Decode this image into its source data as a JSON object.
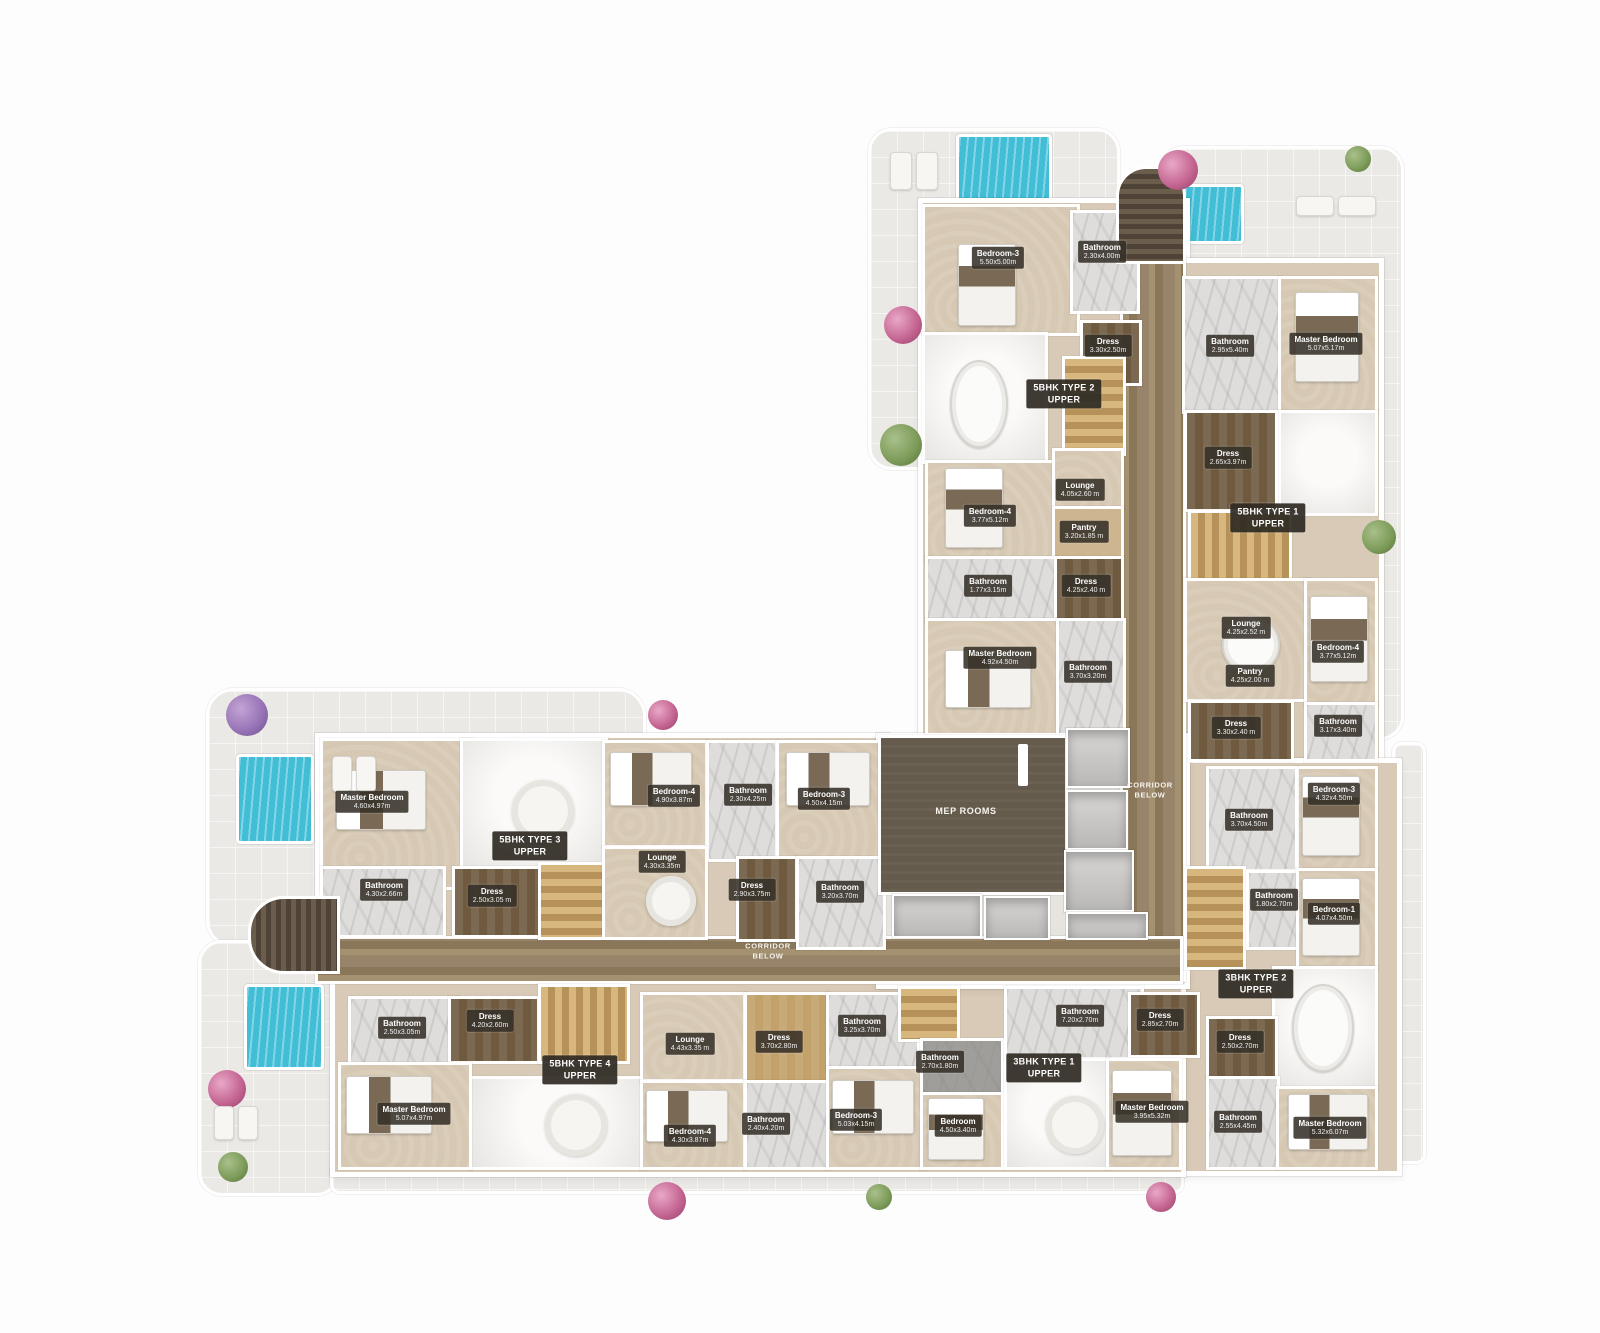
{
  "rooms": {
    "t2_bed3": {
      "name": "Bedroom-3",
      "dims": "5.50x5.00m"
    },
    "t2_bath1": {
      "name": "Bathroom",
      "dims": "2.30x4.00m"
    },
    "t2_dress1": {
      "name": "Dress",
      "dims": "3.30x2.50m"
    },
    "t2_lounge": {
      "name": "Lounge",
      "dims": "4.05x2.60 m"
    },
    "t2_pantry": {
      "name": "Pantry",
      "dims": "3.20x1.85 m"
    },
    "t2_bed4": {
      "name": "Bedroom-4",
      "dims": "3.77x5.12m"
    },
    "t2_bath2": {
      "name": "Bathroom",
      "dims": "1.77x3.15m"
    },
    "t2_dress2": {
      "name": "Dress",
      "dims": "4.25x2.40 m"
    },
    "t2_master": {
      "name": "Master Bedroom",
      "dims": "4.92x4.50m"
    },
    "t2_bath3": {
      "name": "Bathroom",
      "dims": "3.70x3.20m"
    },
    "t1_bath1": {
      "name": "Bathroom",
      "dims": "2.95x5.40m"
    },
    "t1_master": {
      "name": "Master Bedroom",
      "dims": "5.07x5.17m"
    },
    "t1_dress1": {
      "name": "Dress",
      "dims": "2.65x3.97m"
    },
    "t1_lounge": {
      "name": "Lounge",
      "dims": "4.25x2.52 m"
    },
    "t1_pantry": {
      "name": "Pantry",
      "dims": "4.25x2.00 m"
    },
    "t1_bed4": {
      "name": "Bedroom-4",
      "dims": "3.77x5.12m"
    },
    "t1_dress2": {
      "name": "Dress",
      "dims": "3.30x2.40 m"
    },
    "t1_bath2": {
      "name": "Bathroom",
      "dims": "3.17x3.40m"
    },
    "r_bed3": {
      "name": "Bedroom-3",
      "dims": "4.32x4.50m"
    },
    "r_bath1": {
      "name": "Bathroom",
      "dims": "3.70x4.50m"
    },
    "r_bath2": {
      "name": "Bathroom",
      "dims": "1.80x2.70m"
    },
    "r_bed1": {
      "name": "Bedroom-1",
      "dims": "4.07x4.50m"
    },
    "t3_master": {
      "name": "Master Bedroom",
      "dims": "4.60x4.97m"
    },
    "t3_bath1": {
      "name": "Bathroom",
      "dims": "4.30x2.66m"
    },
    "t3_dress1": {
      "name": "Dress",
      "dims": "2.50x3.05 m"
    },
    "t3_bed4": {
      "name": "Bedroom-4",
      "dims": "4.90x3.87m"
    },
    "t3_bath2": {
      "name": "Bathroom",
      "dims": "2.30x4.25m"
    },
    "t3_bed3": {
      "name": "Bedroom-3",
      "dims": "4.50x4.15m"
    },
    "t3_lounge": {
      "name": "Lounge",
      "dims": "4.30x3.35m"
    },
    "t3_dress2": {
      "name": "Dress",
      "dims": "2.90x3.75m"
    },
    "t3_bath3": {
      "name": "Bathroom",
      "dims": "3.20x3.70m"
    },
    "t4_bath1": {
      "name": "Bathroom",
      "dims": "2.50x3.05m"
    },
    "t4_dress1": {
      "name": "Dress",
      "dims": "4.20x2.60m"
    },
    "t4_master": {
      "name": "Master Bedroom",
      "dims": "5.07x4.97m"
    },
    "t4_lounge": {
      "name": "Lounge",
      "dims": "4.43x3.35 m"
    },
    "t4_dress2": {
      "name": "Dress",
      "dims": "3.70x2.80m"
    },
    "t4_bed4": {
      "name": "Bedroom-4",
      "dims": "4.30x3.87m"
    },
    "t4_bath2": {
      "name": "Bathroom",
      "dims": "2.40x4.20m"
    },
    "b1_bath1": {
      "name": "Bathroom",
      "dims": "3.25x3.70m"
    },
    "b1_bed3": {
      "name": "Bedroom-3",
      "dims": "5.03x4.15m"
    },
    "b1_bath2": {
      "name": "Bathroom",
      "dims": "2.70x1.80m"
    },
    "b1_bed": {
      "name": "Bedroom",
      "dims": "4.50x3.40m"
    },
    "b1_bath3": {
      "name": "Bathroom",
      "dims": "7.20x2.70m"
    },
    "b1_dress": {
      "name": "Dress",
      "dims": "2.85x2.70m"
    },
    "b1_master": {
      "name": "Master Bedroom",
      "dims": "3.95x5.32m"
    },
    "b2_dress": {
      "name": "Dress",
      "dims": "2.50x2.70m"
    },
    "b2_bath1": {
      "name": "Bathroom",
      "dims": "2.55x4.45m"
    },
    "b2_master": {
      "name": "Master Bedroom",
      "dims": "5.32x6.07m"
    }
  },
  "units": {
    "u5t1": {
      "name": "5BHK TYPE 1",
      "sub": "UPPER"
    },
    "u5t2": {
      "name": "5BHK TYPE 2",
      "sub": "UPPER"
    },
    "u5t3": {
      "name": "5BHK TYPE 3",
      "sub": "UPPER"
    },
    "u5t4": {
      "name": "5BHK TYPE 4",
      "sub": "UPPER"
    },
    "u3t1": {
      "name": "3BHK TYPE 1",
      "sub": "UPPER"
    },
    "u3t2": {
      "name": "3BHK TYPE 2",
      "sub": "UPPER"
    }
  },
  "areas": {
    "mep": "MEP ROOMS",
    "corridor_line1": "CORRIDOR",
    "corridor_line2": "BELOW"
  },
  "colors": {
    "pool": "#41bdd6",
    "floor": "#d6c8b2",
    "corridor_wood": "#8a775a",
    "mep_dark": "#655b4c",
    "label_bg": "#36302a",
    "terrace": "#ebe9e5",
    "wall": "#ffffff"
  }
}
